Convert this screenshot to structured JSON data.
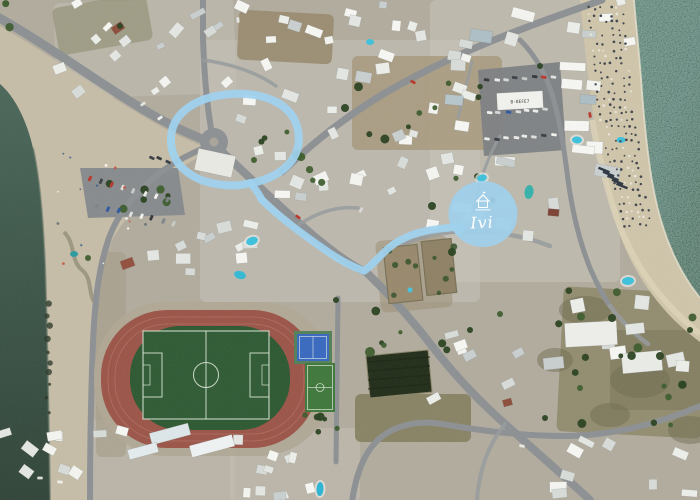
{
  "image_type": "aerial-satellite-map",
  "texts": {
    "parking_rooftop": "B-8EFE7"
  },
  "annotation": {
    "color": "#9fd2ef",
    "loop": {
      "d": "M 252 183 C 285 176 303 156 298 130 C 293 104 264 92 232 94 C 198 96 172 112 171 138 C 170 165 192 182 224 185 C 234 186 244 185 250 183",
      "w": 8
    },
    "tail": {
      "d": "M 250 183 C 257 190 259 195 262 200",
      "w": 7.5
    },
    "route": {
      "d": "M 262 200 C 278 216 302 234 328 252 C 344 263 356 268 364 271 C 374 264 380 255 390 247 C 402 237 420 231 438 229 C 447 228 455 227 459 227",
      "w": 7.5
    },
    "marker": {
      "label": "Ivi",
      "cx": 483,
      "cy": 214,
      "rx": 34.5,
      "ry": 33,
      "fill": "#9fd0eb",
      "label_color": "#ffffff",
      "nub": [
        459,
        228,
        6
      ],
      "icon": "house-icon"
    }
  },
  "colors": {
    "ground": "#b2ac9f",
    "road": "#8d9194",
    "lane": "#979b9d",
    "sand_left": "#c6bda8",
    "sand_right": "#cfc5ab",
    "sea_left_top": "#4d685c",
    "sea_left_mid": "#3e564a",
    "sea_left_bot": "#33463a",
    "sea_right_top": "#4a7568",
    "sea_right_bot": "#3a6254",
    "foam": "#e8e2cf",
    "walkway": "#ddd3b8",
    "track": "#9c564a",
    "lane_line": "#b57c6b",
    "grass": "#2f5a33",
    "pitch_line": "#d9e4d6"
  },
  "shapes": {
    "sea_left": "M 0 84 C 14 96 26 118 33 148 C 40 180 43 220 45 265 C 47 320 48 390 49 440 L 50 502 L 0 502 Z",
    "beach_left": "M 0 26 C 52 56 110 98 160 126 C 182 138 202 146 214 150 C 186 162 164 178 147 198 C 125 218 111 236 104 260 C 96 286 93 310 91 348 C 89 396 88 448 88 502 L 0 502 Z",
    "sea_right": "M 634 0 L 700 0 L 700 298 C 688 283 678 266 670 246 C 660 222 654 196 650 168 C 646 140 643 108 641 78 C 639 52 636 25 634 0 Z",
    "beach_right": "M 580 0 C 584 40 588 80 594 120 C 600 160 608 200 620 235 C 632 268 650 295 672 318 C 682 328 692 336 700 342 L 700 298 C 688 283 678 266 670 246 C 660 222 654 196 650 168 C 646 140 643 108 641 78 C 639 52 636 25 634 0 Z",
    "foam": "M 634 0 C 636 25 639 52 641 78 C 643 108 646 140 650 168 C 654 196 660 222 670 246 C 678 266 688 283 700 298",
    "shore_left": "M 33 148 C 40 180 43 220 45 265 C 47 320 48 390 49 440 L 50 502",
    "walkway": "M 592 120 C 598 152 606 186 616 216 C 628 250 646 280 668 304 C 678 315 690 326 700 334",
    "seaweed": "M 64 232 C 76 244 70 260 82 270 C 94 280 86 296 98 306"
  },
  "patches": [
    [
      200,
      40,
      280,
      262,
      0,
      "#c7c3b8",
      0.55
    ],
    [
      430,
      0,
      190,
      282,
      0,
      "#c9c6bb",
      0.5
    ],
    [
      55,
      0,
      180,
      96,
      -2,
      "#c4c0b5",
      0.5
    ],
    [
      0,
      420,
      235,
      82,
      0,
      "#c2beb2",
      0.5
    ],
    [
      230,
      428,
      130,
      74,
      0,
      "#c3bfb3",
      0.5
    ],
    [
      238,
      12,
      95,
      50,
      3,
      "#97886c",
      0.85
    ],
    [
      352,
      56,
      150,
      94,
      0,
      "#a6977b",
      0.8
    ],
    [
      378,
      238,
      72,
      72,
      -5,
      "#9a8c72",
      0.5
    ],
    [
      560,
      290,
      145,
      145,
      3,
      "#8f8a6c",
      0.9
    ],
    [
      355,
      394,
      116,
      48,
      0,
      "#84805f",
      0.9
    ],
    [
      96,
      252,
      30,
      205,
      0,
      "#a89f8c",
      0.7
    ],
    [
      55,
      0,
      95,
      48,
      -10,
      "#8e8c70",
      0.6
    ],
    [
      610,
      330,
      90,
      80,
      0,
      "#7d7a5e",
      0.6
    ]
  ],
  "scrub_blobs": [
    [
      585,
      310,
      26,
      14
    ],
    [
      640,
      380,
      30,
      18
    ],
    [
      555,
      360,
      18,
      12
    ],
    [
      690,
      430,
      22,
      14
    ],
    [
      610,
      415,
      20,
      12
    ]
  ],
  "roads": [
    {
      "name": "coast-road",
      "d": "M -4 16 C 50 46 108 90 158 118 C 180 130 198 138 216 144",
      "w": 9
    },
    {
      "name": "beach-road-south",
      "d": "M 214 144 C 188 154 166 166 149 182 C 127 202 113 222 106 247 C 98 274 95 302 93 342 C 91 392 90 446 90 502",
      "w": 6
    },
    {
      "name": "main-diagonal-road",
      "d": "M 218 148 C 242 170 268 196 300 224 C 332 252 352 266 366 272 C 390 295 412 320 432 346 C 452 372 478 400 505 424 C 532 448 562 474 590 500",
      "w": 8
    },
    {
      "name": "northeast-road",
      "d": "M 282 172 C 318 138 352 112 392 89 C 436 64 484 43 530 26 C 556 16 580 8 602 0",
      "w": 7
    },
    {
      "name": "north-road",
      "d": "M 213 140 C 207 108 204 72 203 38 L 203 -4",
      "w": 6
    },
    {
      "name": "marker-street",
      "d": "M 364 271 C 380 257 398 244 420 238 C 444 231 466 230 488 232 C 512 234 532 239 550 246",
      "w": 4.5
    },
    {
      "name": "east-road",
      "d": "M 520 40 C 538 58 549 80 555 105 C 561 127 564 150 567 172 C 571 205 578 238 590 268 C 597 284 603 296 610 306",
      "w": 5
    },
    {
      "name": "south-road",
      "d": "M 352 502 C 356 474 364 452 380 438 C 396 425 418 420 442 424 C 482 431 522 436 562 436 C 612 436 658 424 700 406",
      "w": 6
    },
    {
      "name": "stadium-road",
      "d": "M 338 298 L 336 462",
      "w": 5
    },
    {
      "name": "lane-1",
      "d": "M 300 224 C 318 212 338 206 358 208",
      "w": 3.5
    },
    {
      "name": "lane-2",
      "d": "M 472 62 L 458 118",
      "w": 3
    },
    {
      "name": "lane-3",
      "d": "M 500 136 C 486 160 478 186 474 212",
      "w": 3
    },
    {
      "name": "lane-4",
      "d": "M 203 60 C 232 64 256 72 276 86",
      "w": 3.5
    },
    {
      "name": "lane-5",
      "d": "M 610 306 C 622 322 634 334 648 344",
      "w": 4.5
    },
    {
      "name": "lane-6",
      "d": "M 505 424 C 492 440 484 458 480 478 C 478 488 477 496 477 502",
      "w": 4
    }
  ],
  "avoid_segments": [
    [
      [
        -4,
        16
      ],
      [
        216,
        144
      ]
    ],
    [
      [
        218,
        148
      ],
      [
        505,
        424
      ]
    ],
    [
      [
        282,
        172
      ],
      [
        602,
        0
      ]
    ],
    [
      [
        364,
        271
      ],
      [
        550,
        246
      ]
    ],
    [
      [
        203,
        38
      ],
      [
        213,
        140
      ]
    ],
    [
      [
        90,
        250
      ],
      [
        90,
        500
      ]
    ]
  ],
  "roundabout": {
    "cx": 214,
    "cy": 142,
    "r": 14,
    "island_r": 4.5,
    "island_fill": "#aaa59a"
  },
  "parking_lots": [
    {
      "pts": "80,168 178,168 185,215 88,218",
      "fill": "#85898c"
    },
    {
      "pts": "478,70 560,62 566,150 484,156",
      "fill": "#7d8184"
    }
  ],
  "stadium": {
    "apron": [
      94,
      302,
      238,
      154,
      72
    ],
    "outer": [
      101,
      310,
      217,
      138,
      66
    ],
    "inner": [
      130,
      326,
      160,
      104,
      50
    ],
    "pitch": {
      "x": 143,
      "y": 331,
      "w": 126,
      "h": 88,
      "center_x": 206,
      "circle_r": 12.5,
      "pen_depth": 19,
      "pen_w": 44,
      "goal_depth": 7,
      "goal_w": 20
    }
  },
  "basketball_court": {
    "x": 294,
    "y": 331,
    "w": 38,
    "h": 33,
    "surround": "#55815a",
    "surface": "#3a6abf"
  },
  "futsal_court": {
    "x": 305,
    "y": 363,
    "w": 30,
    "h": 49,
    "surface": "#41793d"
  },
  "dark_field": {
    "pts": "366,356 428,350 432,392 370,398",
    "fill": "#242f1c"
  },
  "walled_fields": [
    [
      386,
      246,
      34,
      56,
      -6,
      "#998a6e"
    ],
    [
      424,
      240,
      30,
      54,
      -6,
      "#8f8266"
    ]
  ],
  "pools": [
    [
      482,
      178,
      5,
      3.5,
      -15,
      "#3fc1dc",
      1
    ],
    [
      529,
      192,
      4.5,
      7,
      8,
      "#38b2ab",
      0
    ],
    [
      252,
      241,
      6,
      4,
      -20,
      "#3fc1dc",
      1
    ],
    [
      240,
      275,
      6,
      4,
      15,
      "#36b9d4",
      0
    ],
    [
      577,
      140,
      5,
      3.5,
      5,
      "#3fc1dc",
      1
    ],
    [
      621,
      140,
      4.5,
      3,
      0,
      "#3fc1dc",
      0
    ],
    [
      628,
      281,
      6,
      4,
      -5,
      "#3fc1dc",
      1
    ],
    [
      410,
      290,
      2.5,
      2.5,
      0,
      "#46c4de",
      0
    ],
    [
      370,
      42,
      4,
      3,
      0,
      "#3fc1dc",
      0
    ],
    [
      74,
      254,
      4,
      3,
      0,
      "#2f9ba0",
      0
    ],
    [
      320,
      489,
      3.5,
      7,
      3,
      "#2fb4d4",
      1
    ]
  ],
  "buildings": {
    "palette": [
      "#f3f4f0",
      "#eceeea",
      "#e3e6e2",
      "#d8dcd9",
      "#c9cfcf",
      "#f6f6f3"
    ],
    "clusters": [
      [
        58,
        2,
        170,
        90,
        18,
        6,
        16,
        5,
        10,
        -35,
        18
      ],
      [
        238,
        2,
        195,
        54,
        13,
        7,
        17,
        6,
        11,
        5,
        22
      ],
      [
        236,
        64,
        226,
        138,
        32,
        7,
        16,
        6,
        12,
        0,
        30
      ],
      [
        432,
        4,
        164,
        52,
        9,
        10,
        24,
        7,
        13,
        8,
        14
      ],
      [
        432,
        158,
        146,
        96,
        11,
        10,
        22,
        7,
        13,
        4,
        14
      ],
      [
        566,
        56,
        42,
        118,
        7,
        12,
        26,
        8,
        13,
        3,
        8
      ],
      [
        432,
        58,
        44,
        96,
        6,
        9,
        18,
        7,
        12,
        5,
        15
      ],
      [
        148,
        204,
        104,
        82,
        11,
        7,
        15,
        6,
        11,
        -10,
        26
      ],
      [
        2,
        424,
        140,
        72,
        10,
        7,
        16,
        6,
        11,
        10,
        30
      ],
      [
        232,
        432,
        126,
        64,
        11,
        7,
        15,
        6,
        11,
        0,
        26
      ],
      [
        558,
        440,
        138,
        56,
        9,
        8,
        18,
        6,
        11,
        10,
        20
      ],
      [
        544,
        252,
        150,
        126,
        8,
        12,
        24,
        8,
        14,
        -4,
        12
      ],
      [
        428,
        332,
        92,
        70,
        7,
        8,
        15,
        6,
        10,
        -22,
        16
      ],
      [
        600,
        0,
        34,
        46,
        4,
        8,
        14,
        6,
        10,
        -8,
        12
      ]
    ],
    "special": [
      [
        121,
        259,
        13,
        9,
        -20,
        "#93513f"
      ],
      [
        548,
        209,
        11,
        7,
        5,
        "#7e4437"
      ],
      [
        503,
        399,
        9,
        7,
        -15,
        "#8e4f3d"
      ],
      [
        112,
        24,
        12,
        8,
        -35,
        "#8f4e3e"
      ],
      [
        470,
        30,
        22,
        12,
        8,
        "#aebfc6"
      ],
      [
        445,
        95,
        18,
        10,
        5,
        "#b7c6cb"
      ],
      [
        580,
        95,
        16,
        9,
        3,
        "#adbec5"
      ],
      [
        565,
        322,
        52,
        24,
        -3,
        "#edeeea"
      ],
      [
        622,
        352,
        40,
        20,
        -5,
        "#e9ebe7"
      ],
      [
        196,
        152,
        38,
        22,
        12,
        "#e9e9e4"
      ],
      [
        150,
        428,
        40,
        12,
        -15,
        "#dde6e9"
      ],
      [
        190,
        440,
        44,
        12,
        -15,
        "#eef2f2"
      ],
      [
        128,
        446,
        30,
        10,
        -15,
        "#e4ebee"
      ],
      [
        497,
        92,
        46,
        17,
        -3,
        "#f1f2ee"
      ]
    ]
  },
  "trees": {
    "clusters": [
      [
        86,
        182,
        92,
        28,
        7
      ],
      [
        352,
        62,
        146,
        86,
        9
      ],
      [
        282,
        150,
        58,
        40,
        4
      ],
      [
        538,
        282,
        158,
        146,
        12
      ],
      [
        360,
        300,
        108,
        58,
        6
      ],
      [
        600,
        330,
        92,
        78,
        5
      ],
      [
        232,
        92,
        58,
        56,
        3
      ],
      [
        2,
        2,
        58,
        40,
        3
      ],
      [
        436,
        150,
        60,
        56,
        3
      ],
      [
        300,
        414,
        38,
        44,
        6
      ]
    ],
    "explicit": [
      [
        297,
        155,
        5
      ],
      [
        345,
        108,
        4
      ],
      [
        432,
        206,
        4
      ],
      [
        452,
        252,
        4
      ],
      [
        370,
        352,
        5
      ],
      [
        336,
        300,
        3
      ],
      [
        254,
        160,
        3
      ],
      [
        120,
        26,
        3
      ],
      [
        88,
        258,
        3
      ],
      [
        540,
        66,
        3
      ],
      [
        612,
        318,
        4
      ],
      [
        660,
        356,
        4
      ],
      [
        690,
        330,
        3
      ],
      [
        580,
        388,
        3
      ],
      [
        545,
        418,
        3
      ],
      [
        470,
        330,
        3
      ],
      [
        500,
        314,
        3
      ]
    ]
  },
  "cars": {
    "palette": [
      "#ececea",
      "#f2f2ee",
      "#d6d8d6",
      "#b83a2c",
      "#3c4248",
      "#7e858a",
      "#2e58a0",
      "#e0e0dc",
      "#c8cac8",
      "#35383c"
    ],
    "rows": [
      [
        90,
        179,
        11,
        3,
        8,
        115
      ],
      [
        97,
        206,
        11,
        2.5,
        8,
        115
      ],
      [
        487,
        80,
        9.5,
        -0.5,
        8,
        8
      ],
      [
        489,
        113,
        9.5,
        -0.5,
        7,
        8
      ],
      [
        487,
        139,
        9.5,
        -0.5,
        8,
        8
      ],
      [
        152,
        157,
        8,
        2,
        3,
        25
      ]
    ],
    "street": [
      [
        413,
        82,
        30,
        "#b83a2c"
      ],
      [
        298,
        217,
        38,
        "#b83a2c"
      ],
      [
        590,
        115,
        80,
        "#b83a2c"
      ],
      [
        160,
        118,
        -35,
        "#f0f0ec"
      ],
      [
        143,
        104,
        -35,
        "#e2e4e2"
      ],
      [
        522,
        446,
        12,
        "#e8e8e4"
      ],
      [
        238,
        20,
        85,
        "#e8e8e4"
      ],
      [
        361,
        210,
        -60,
        "#d8d8d4"
      ],
      [
        60,
        482,
        5,
        "#eeeeea"
      ],
      [
        40,
        478,
        0,
        "#dddddb"
      ]
    ]
  },
  "beach_detail": {
    "shore_pts": [
      [
        0,
        634
      ],
      [
        78,
        641
      ],
      [
        168,
        650
      ],
      [
        246,
        668
      ],
      [
        300,
        700
      ]
    ],
    "edge_pts": [
      [
        0,
        584
      ],
      [
        120,
        596
      ],
      [
        235,
        622
      ],
      [
        318,
        674
      ]
    ],
    "umbrella_dark": "#43484e",
    "umbrella_light": "#e8e4d8",
    "sunbed_bars": [
      [
        604,
        170
      ],
      [
        608.5,
        174
      ],
      [
        613,
        178
      ],
      [
        617.5,
        182
      ],
      [
        622,
        186
      ]
    ],
    "left_speck_region": [
      55,
      150,
      100,
      120
    ]
  }
}
